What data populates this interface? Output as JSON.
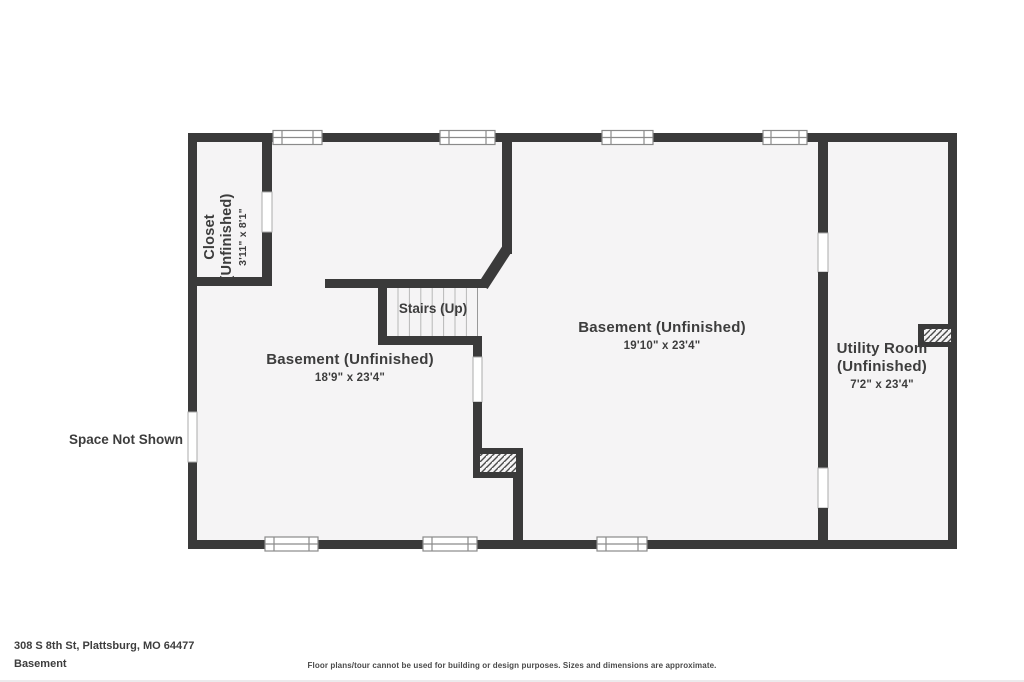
{
  "page": {
    "background": "#ffffff",
    "floor_fill": "#f5f4f5",
    "wall_color": "#3a3a3a",
    "text_color": "#3d3d3d"
  },
  "floorplan": {
    "rooms": [
      {
        "id": "closet",
        "name": "Closet",
        "qualifier": "(Unfinished)",
        "dimensions": "3'11\" x 8'1\""
      },
      {
        "id": "basement-left",
        "name": "Basement (Unfinished)",
        "dimensions": "18'9\" x 23'4\""
      },
      {
        "id": "basement-right",
        "name": "Basement (Unfinished)",
        "dimensions": "19'10\" x 23'4\""
      },
      {
        "id": "utility-room",
        "name": "Utility Room",
        "qualifier": "(Unfinished)",
        "dimensions": "7'2\" x 23'4\""
      }
    ],
    "stairs_label": "Stairs (Up)",
    "space_not_shown": "Space Not Shown"
  },
  "footer": {
    "address": "308 S 8th St, Plattsburg, MO 64477",
    "floor_name": "Basement",
    "disclaimer": "Floor plans/tour cannot be used for building or design purposes. Sizes and dimensions are approximate."
  }
}
